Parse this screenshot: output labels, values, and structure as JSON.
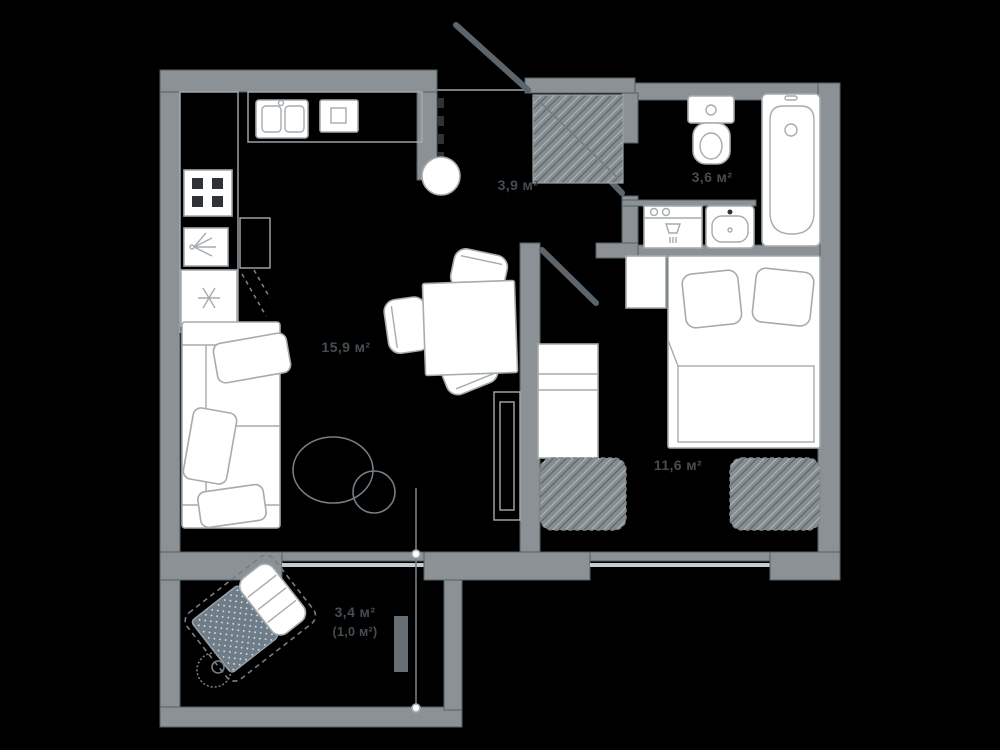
{
  "plan": {
    "type": "apartment-floor-plan",
    "unit": "м²",
    "colors": {
      "background": "#000000",
      "wall": "#8b9194",
      "wall_edge": "#565f64",
      "furniture_fill": "#ffffff",
      "furniture_stroke": "#a5abae",
      "sketch": "#747e84",
      "door": "#5b656b",
      "label": "#454d52",
      "glass": "#c6cbcd",
      "accent_textile": "#6e7d88"
    },
    "rooms": {
      "living_room": {
        "name": "kitchen-living-room",
        "area_label": "15,9 м²"
      },
      "hallway": {
        "name": "hallway",
        "area_label": "3,9 м²"
      },
      "bathroom": {
        "name": "bathroom",
        "area_label": "3,6 м²"
      },
      "bedroom": {
        "name": "bedroom",
        "area_label": "11,6 м²"
      },
      "balcony": {
        "name": "balcony",
        "area_total_label": "3,4 м²",
        "area_reduced_label": "(1,0 м²)"
      }
    }
  }
}
